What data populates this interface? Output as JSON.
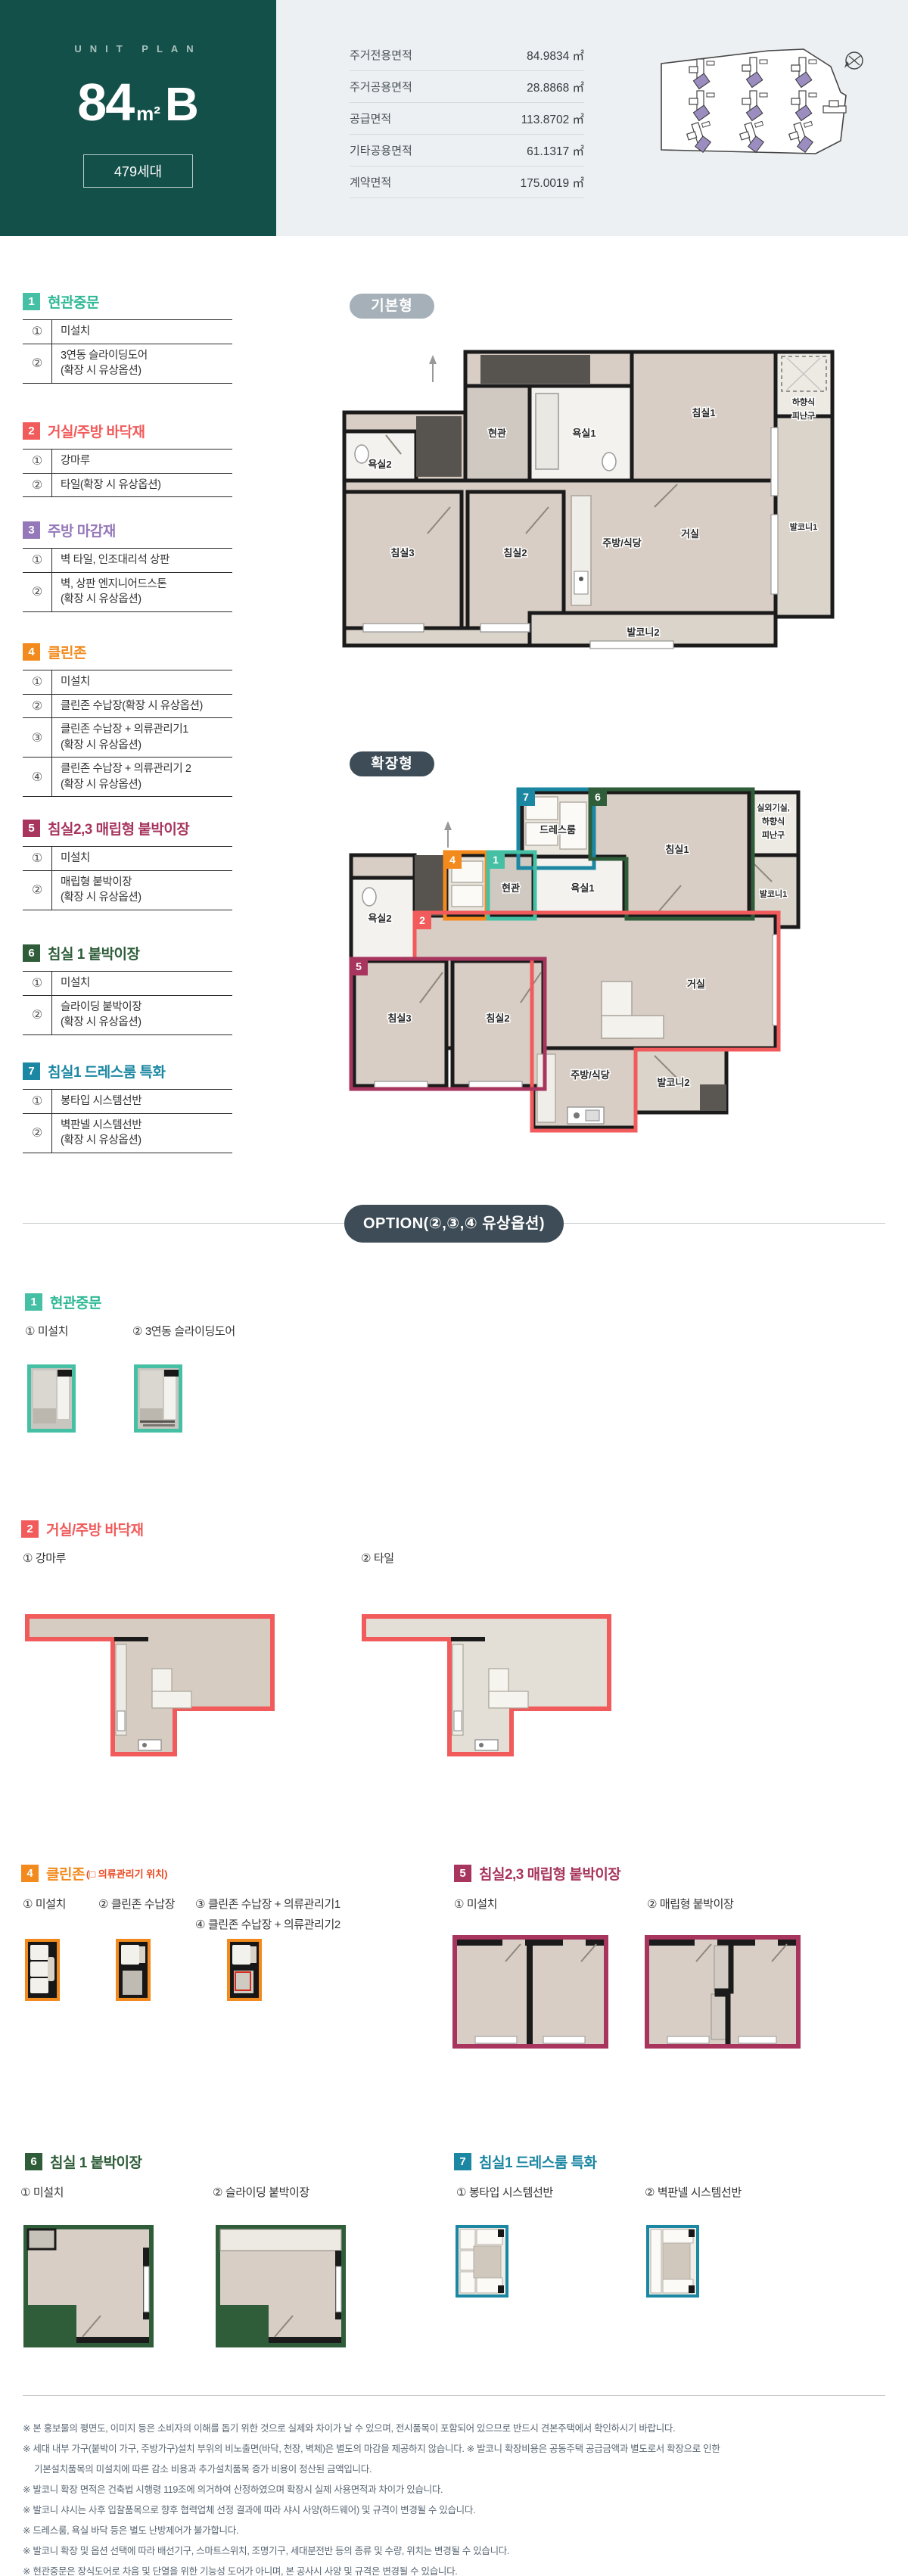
{
  "hero": {
    "eyebrow": "UNIT PLAN",
    "size": "84",
    "unit": "m²",
    "type": "B",
    "households": "479세대"
  },
  "area_table": {
    "rows": [
      {
        "label": "주거전용면적",
        "value": "84.9834 ㎡"
      },
      {
        "label": "주거공용면적",
        "value": "28.8868 ㎡"
      },
      {
        "label": "공급면적",
        "value": "113.8702 ㎡"
      },
      {
        "label": "기타공용면적",
        "value": "61.1317 ㎡"
      },
      {
        "label": "계약면적",
        "value": "175.0019 ㎡"
      }
    ]
  },
  "spec_sections": [
    {
      "num": "1",
      "title": "현관중문",
      "color": "#45C0A4",
      "rows": [
        {
          "no": "①",
          "lines": [
            "미설치"
          ]
        },
        {
          "no": "②",
          "lines": [
            "3연동 슬라이딩도어",
            "(확장 시 유상옵션)"
          ]
        }
      ]
    },
    {
      "num": "2",
      "title": "거실/주방 바닥재",
      "color": "#F15B5B",
      "rows": [
        {
          "no": "①",
          "lines": [
            "강마루"
          ]
        },
        {
          "no": "②",
          "lines": [
            "타일(확장 시 유상옵션)"
          ]
        }
      ]
    },
    {
      "num": "3",
      "title": "주방 마감재",
      "color": "#9478B9",
      "rows": [
        {
          "no": "①",
          "lines": [
            "벽 타일, 인조대리석 상판"
          ]
        },
        {
          "no": "②",
          "lines": [
            "벽, 상판 엔지니어드스톤",
            "(확장 시 유상옵션)"
          ]
        }
      ]
    },
    {
      "num": "4",
      "title": "클린존",
      "color": "#F28A1E",
      "rows": [
        {
          "no": "①",
          "lines": [
            "미설치"
          ]
        },
        {
          "no": "②",
          "lines": [
            "클린존 수납장(확장 시 유상옵션)"
          ]
        },
        {
          "no": "③",
          "lines": [
            "클린존 수납장 + 의류관리기1",
            "(확장 시 유상옵션)"
          ]
        },
        {
          "no": "④",
          "lines": [
            "클린존 수납장 + 의류관리기 2",
            "(확장 시 유상옵션)"
          ]
        }
      ]
    },
    {
      "num": "5",
      "title": "침실2,3 매립형 붙박이장",
      "color": "#A7355D",
      "rows": [
        {
          "no": "①",
          "lines": [
            "미설치"
          ]
        },
        {
          "no": "②",
          "lines": [
            "매립형 붙박이장",
            "(확장 시 유상옵션)"
          ]
        }
      ]
    },
    {
      "num": "6",
      "title": "침실 1 붙박이장",
      "color": "#2F5D39",
      "rows": [
        {
          "no": "①",
          "lines": [
            "미설치"
          ]
        },
        {
          "no": "②",
          "lines": [
            "슬라이딩 붙박이장",
            "(확장 시 유상옵션)"
          ]
        }
      ]
    },
    {
      "num": "7",
      "title": "침실1 드레스룸 특화",
      "color": "#1B87A2",
      "rows": [
        {
          "no": "①",
          "lines": [
            "봉타입 시스템선반"
          ]
        },
        {
          "no": "②",
          "lines": [
            "벽판넬 시스템선반",
            "(확장 시 유상옵션)"
          ]
        }
      ]
    }
  ],
  "plans": {
    "basic": {
      "tag": "기본형",
      "rooms": {
        "bed1": "침실1",
        "esc1": "하향식",
        "esc2": "피난구",
        "entry": "현관",
        "bath1": "욕실1",
        "bath2": "욕실2",
        "balcony1": "발코니1",
        "living": "거실",
        "bed3": "침실3",
        "bed2": "침실2",
        "kitchen": "주방/식당",
        "balcony2": "발코니2"
      }
    },
    "extended": {
      "tag": "확장형",
      "rooms": {
        "dress": "드레스룸",
        "bed1": "침실1",
        "out1": "실외기실,",
        "esc1": "하향식",
        "esc2": "피난구",
        "entry": "현관",
        "bath1": "욕실1",
        "bath2": "욕실2",
        "balcony1": "발코니1",
        "living": "거실",
        "bed3": "침실3",
        "bed2": "침실2",
        "kitchen": "주방/식당",
        "balcony2": "발코니2"
      },
      "tags": {
        "t1": "1",
        "t2": "2",
        "t4": "4",
        "t5": "5",
        "t6": "6",
        "t7": "7"
      }
    }
  },
  "option": {
    "divider": "OPTION(②,③,④ 유상옵션)",
    "s1": {
      "num": "1",
      "title": "현관중문",
      "item1": "① 미설치",
      "item2": "② 3연동 슬라이딩도어"
    },
    "s2": {
      "num": "2",
      "title": "거실/주방 바닥재",
      "item1": "① 강마루",
      "item2": "② 타일"
    },
    "s4": {
      "num": "4",
      "title": "클린존",
      "note": "(□ 의류관리기 위치)",
      "item1": "① 미설치",
      "item2": "② 클린존 수납장",
      "item3": "③ 클린존 수납장 + 의류관리기1",
      "item4": "④ 클린존 수납장 + 의류관리기2"
    },
    "s5": {
      "num": "5",
      "title": "침실2,3 매립형 붙박이장",
      "item1": "① 미설치",
      "item2": "② 매립형 붙박이장"
    },
    "s6": {
      "num": "6",
      "title": "침실 1 붙박이장",
      "item1": "① 미설치",
      "item2": "② 슬라이딩 붙박이장"
    },
    "s7": {
      "num": "7",
      "title": "침실1 드레스룸 특화",
      "item1": "① 봉타입 시스템선반",
      "item2": "② 벽판넬 시스템선반"
    }
  },
  "disclaimers": [
    "※ 본 홍보물의 평면도, 이미지 등은 소비자의 이해를 돕기 위한 것으로 실제와 차이가 날 수 있으며, 전시품목이 포함되어 있으므로 반드시 견본주택에서 확인하시기 바랍니다.",
    "※ 세대 내부 가구(붙박이 가구, 주방가구)설치 부위의 비노출면(바닥, 천장, 벽체)은 별도의 마감을 제공하지 않습니다. ※ 발코니 확장비용은 공동주택 공급금액과 별도로서 확장으로 인한",
    "기본설치품목의 미설치에 따른 감소 비용과 추가설치품목 증가 비용이 정산된 금액입니다.",
    "※ 발코니 확장 면적은 건축법 시행령 119조에 의거하여 산정하였으며 확장시 실제 사용면적과 차이가 있습니다.",
    "※ 발코니 샤시는 사후 입찰품목으로 향후 협력업체 선정 결과에 따라 샤시 사양(하드웨어) 및 규격이 변경될 수 있습니다.",
    "※ 드레스룸, 욕실 바닥 등은 별도 난방제어가 불가합니다.",
    "※ 발코니 확장 및 옵션 선택에 따라 배선기구, 스마트스위치, 조명기구, 세대분전반 등의 종류 및 수량, 위치는 변경될 수 있습니다.",
    "※ 현관중문은 장식도어로 차음 및 단열을 위한 기능성 도어가 아니며, 본 공사시 사양 및 규격은 변경될 수 있습니다."
  ],
  "colors": {
    "hero_bg": "#14504A",
    "band_bg": "#ECF0F2",
    "option_pill": "#3D4C56",
    "unit_highlight": "#9C8DC0"
  }
}
